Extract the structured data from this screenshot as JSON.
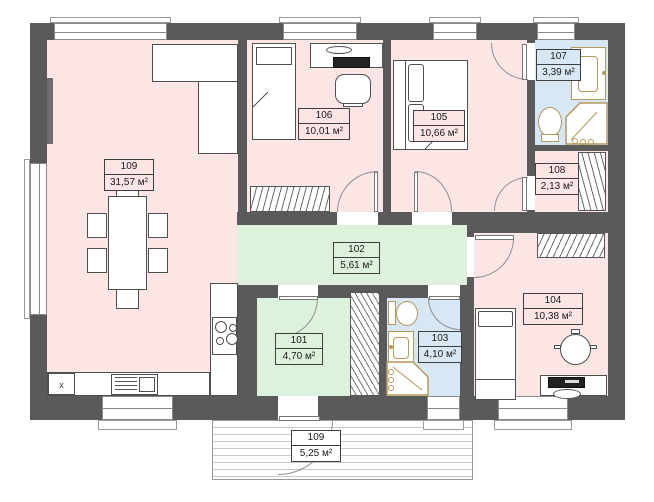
{
  "plan": {
    "rooms": {
      "r109": {
        "number": "109",
        "area": "31,57 м²",
        "color": "#fbe5e5"
      },
      "r106": {
        "number": "106",
        "area": "10,01 м²",
        "color": "#fbe5e5"
      },
      "r105": {
        "number": "105",
        "area": "10,66 м²",
        "color": "#fbe5e5"
      },
      "r107": {
        "number": "107",
        "area": "3,39 м²",
        "color": "#d7e7f3"
      },
      "r108": {
        "number": "108",
        "area": "2,13 м²",
        "color": "#fbe5e5"
      },
      "r102": {
        "number": "102",
        "area": "5,61 м²",
        "color": "#dcf2dc"
      },
      "r101": {
        "number": "101",
        "area": "4,70 м²",
        "color": "#dcf2dc"
      },
      "r103": {
        "number": "103",
        "area": "4,10 м²",
        "color": "#d7e7f3"
      },
      "r104": {
        "number": "104",
        "area": "10,38 м²",
        "color": "#fbe5e5"
      },
      "porch": {
        "number": "109",
        "area": "5,25 м²",
        "color": "#ffffff"
      }
    },
    "kitchen_x_label": "x",
    "colors": {
      "wall": "#5a5a5a",
      "fixture": "#b5985c",
      "pink": "#fbe5e5",
      "green": "#dcf2dc",
      "blue": "#d7e7f3"
    }
  }
}
